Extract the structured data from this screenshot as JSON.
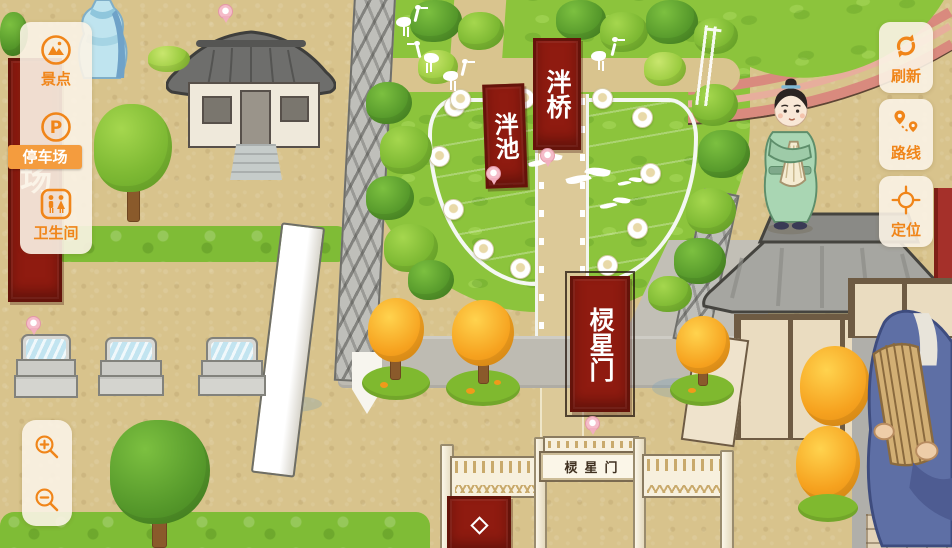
{
  "colors": {
    "accent": "#F08519",
    "panel_bg": "#FBF3E5",
    "active_item_bg": "#F49C3E",
    "active_item_text": "#FFFFFF",
    "banner_red": "#8F1B10",
    "banner_text": "#FFFFFF",
    "pond_blue": "#9ED8E8",
    "park_green": "#8CC43C",
    "ground_tan": "#D8C38C"
  },
  "left_menu": {
    "items": [
      {
        "label": "景点",
        "icon": "scenic-spot-icon",
        "active": false
      },
      {
        "label": "停车场",
        "icon": "parking-icon",
        "active": true
      },
      {
        "label": "卫生间",
        "icon": "restroom-icon",
        "active": false
      }
    ]
  },
  "right_menu": {
    "items": [
      {
        "label": "刷新",
        "icon": "refresh-icon"
      },
      {
        "label": "路线",
        "icon": "route-icon"
      },
      {
        "label": "定位",
        "icon": "locate-icon"
      }
    ]
  },
  "zoom_controls": {
    "zoom_in": "zoom-in-icon",
    "zoom_out": "zoom-out-icon"
  },
  "map": {
    "banners": {
      "pan_bridge": "泮桥",
      "pan_pond": "泮池",
      "lingxing_gate": "棂星门",
      "parking_partial": "场"
    },
    "gate_plaque": "棂星门"
  }
}
